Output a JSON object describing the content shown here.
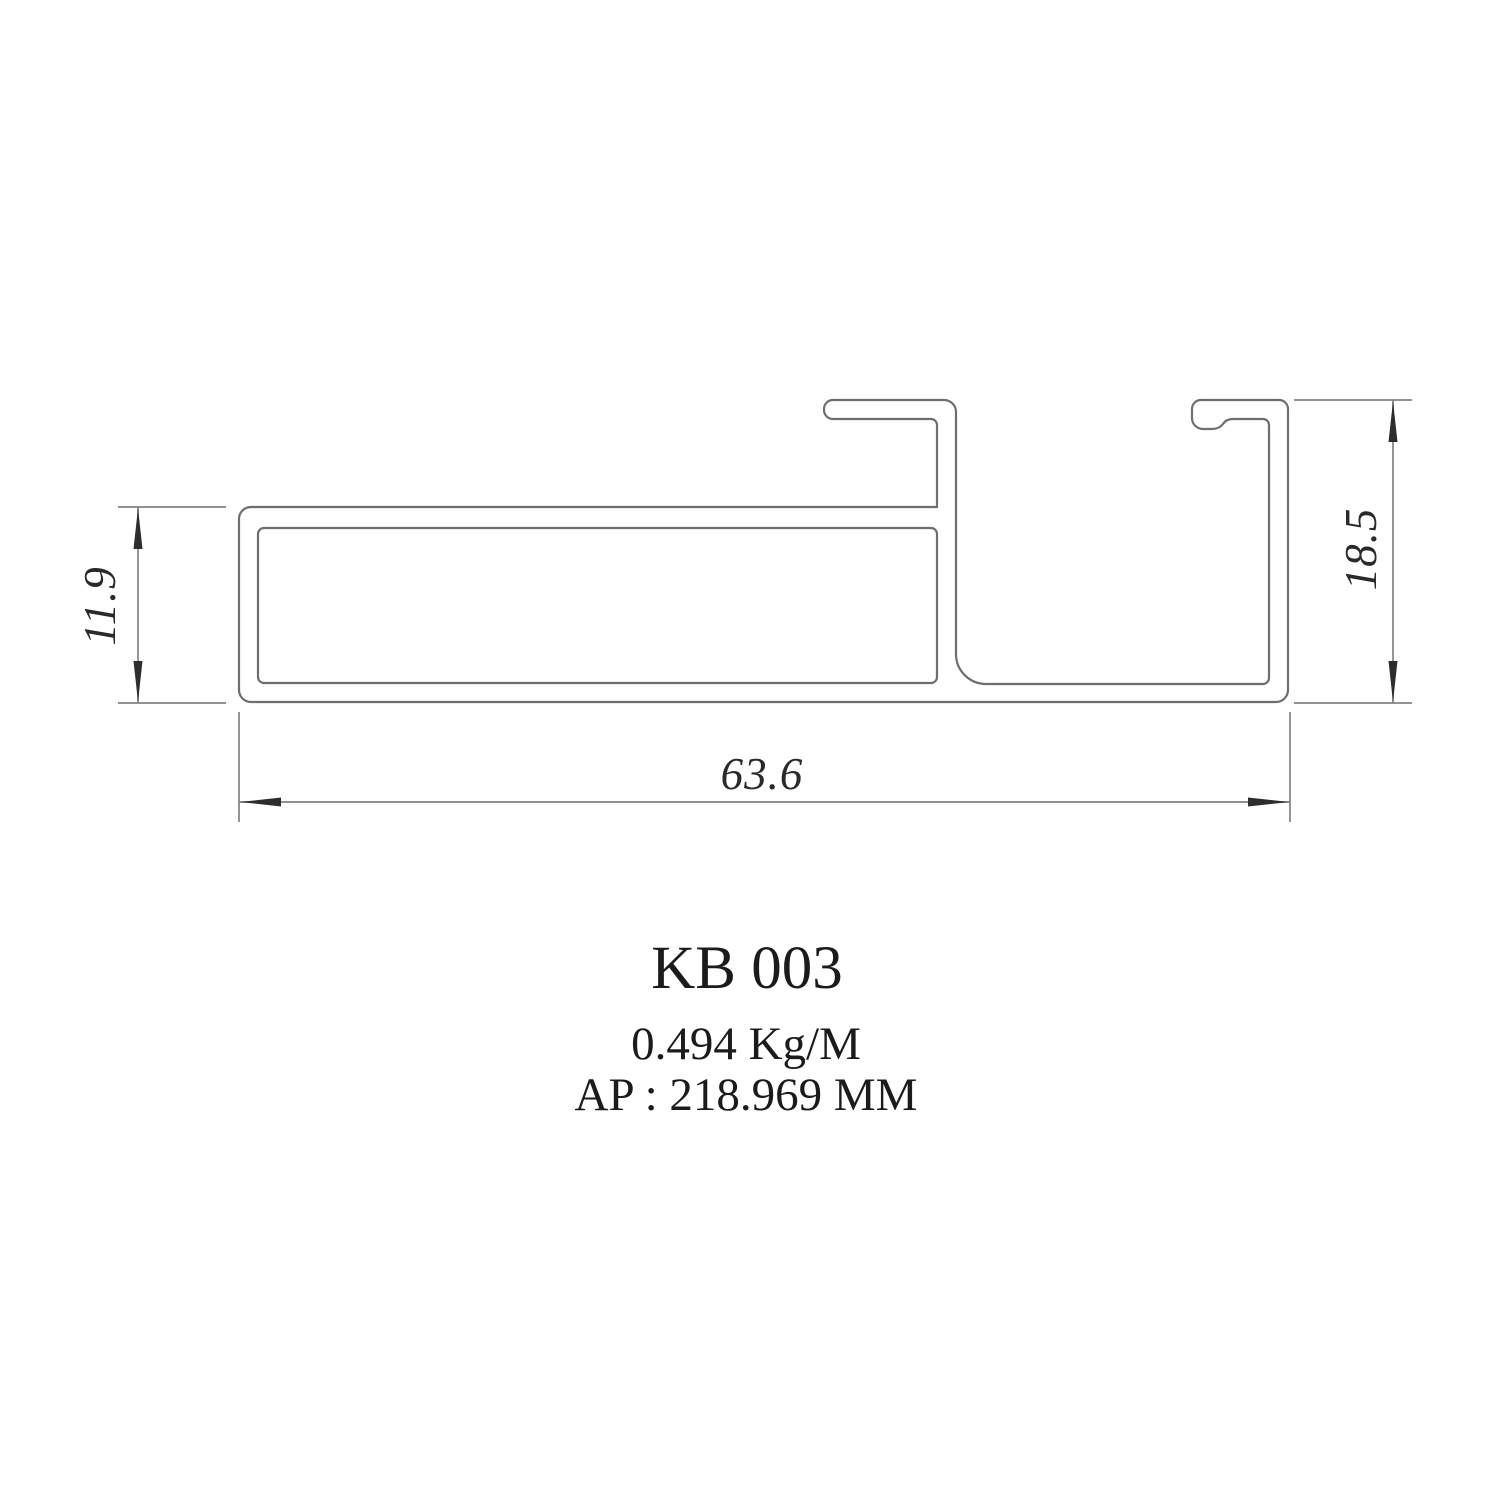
{
  "drawing": {
    "profile_code": "KB 003",
    "unit_weight": "0.494 Kg/M",
    "perimeter": "AP : 218.969 MM",
    "dimensions": {
      "tube_height": "11.9",
      "channel_height": "18.5",
      "overall_width": "63.6"
    },
    "colors": {
      "profile_line": "#6e6e6e",
      "dimension_line": "#828282",
      "arrow": "#2d2d2d",
      "text": "#1b1b1b"
    }
  }
}
